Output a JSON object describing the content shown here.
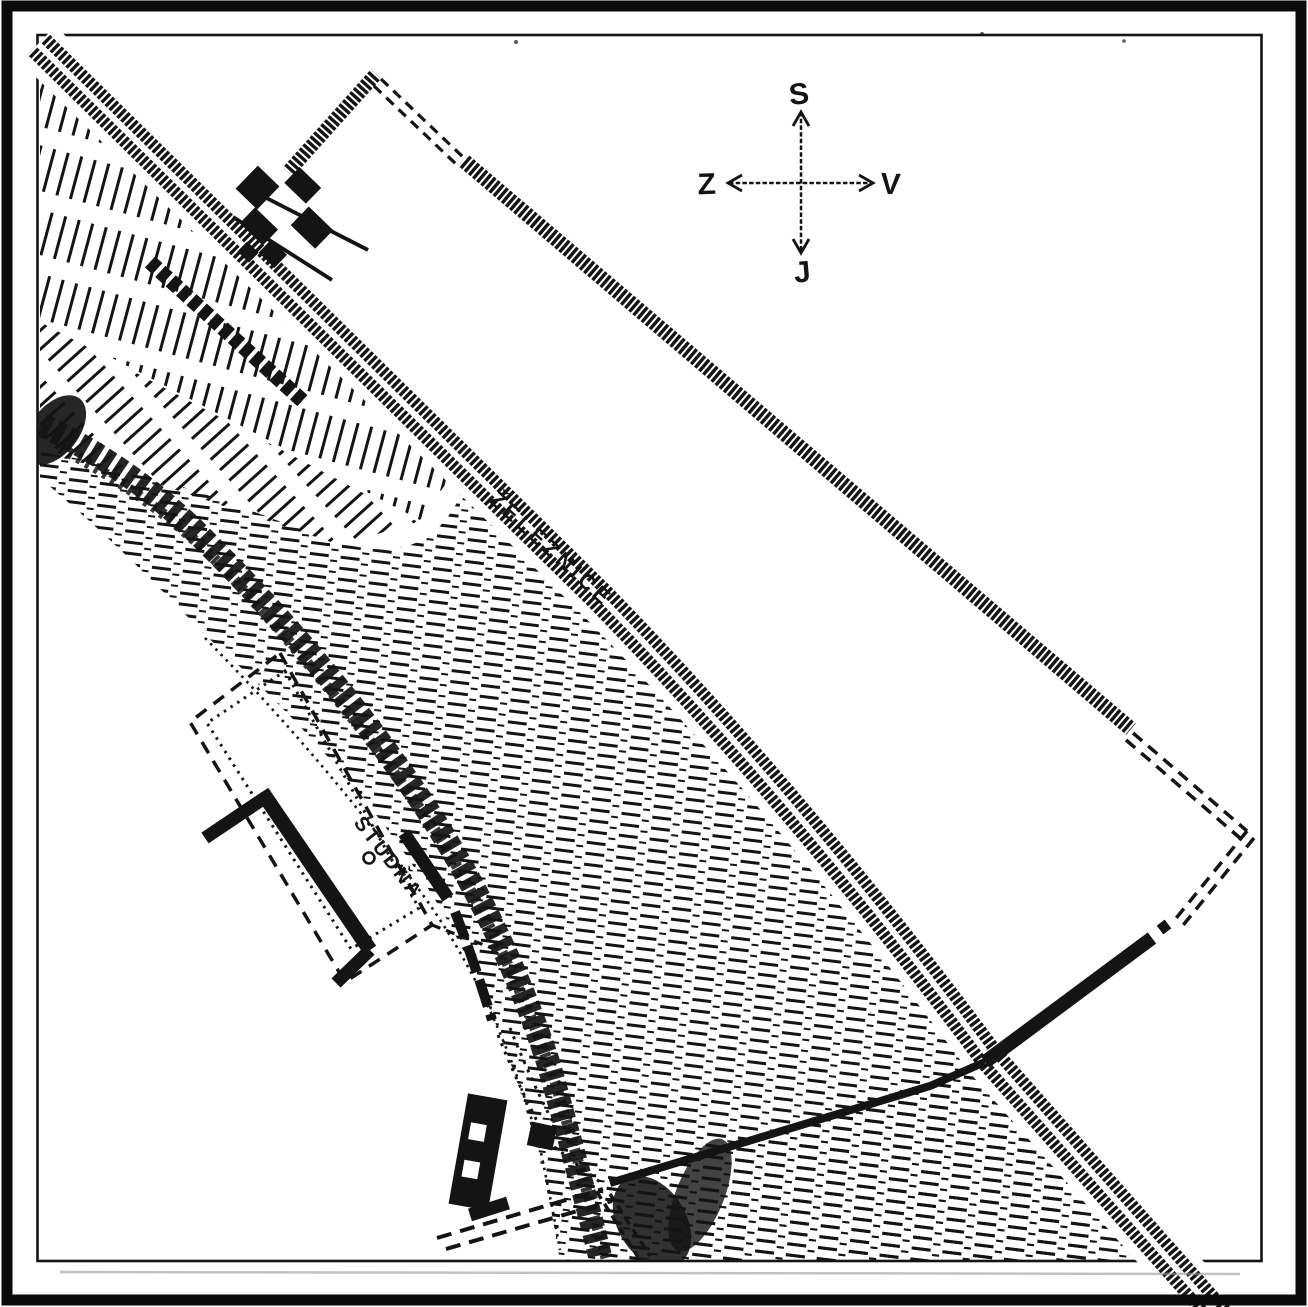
{
  "map": {
    "labels": {
      "railway": "ŽELEZNICE",
      "well": "STUDŇA"
    },
    "compass": {
      "north": "S",
      "south": "J",
      "west": "Z",
      "east": "V"
    },
    "colors": {
      "ink": "#141414",
      "paper": "#ffffff"
    }
  }
}
